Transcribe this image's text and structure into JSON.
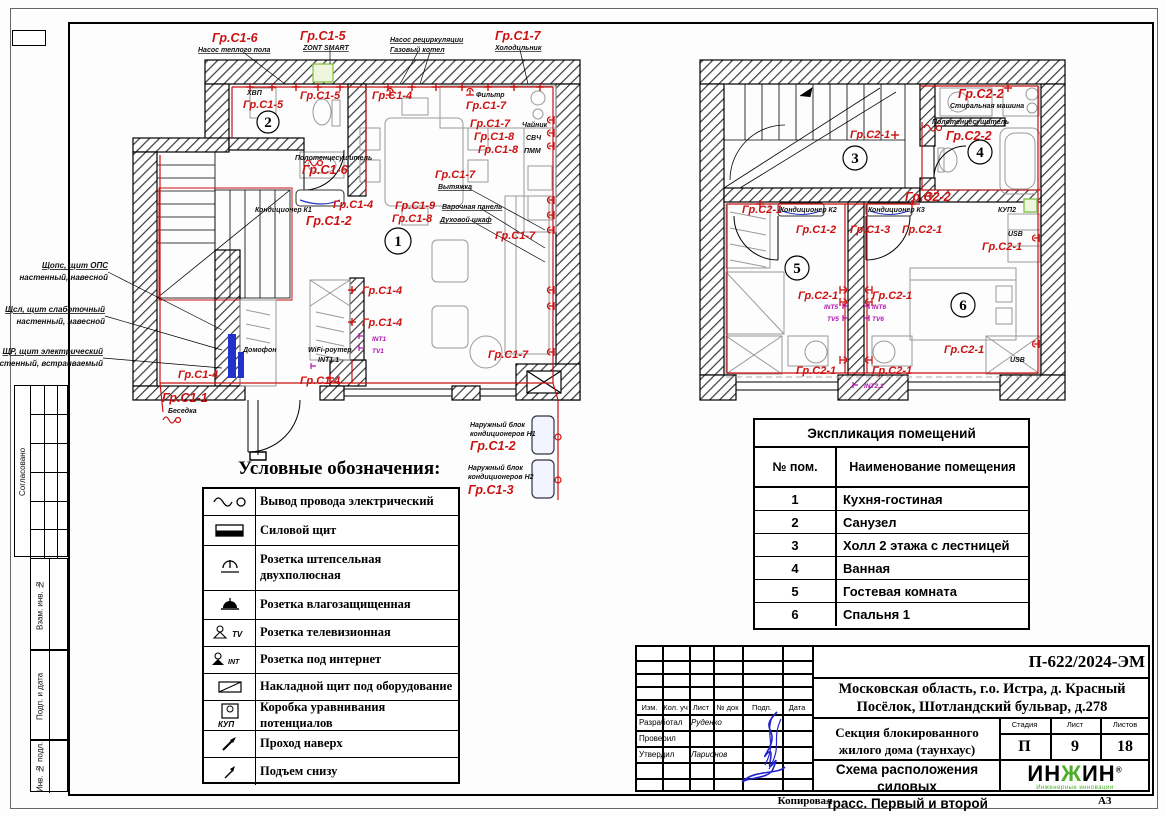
{
  "doc": {
    "copied": "Копировал",
    "format": "А3",
    "side_agreed": "Согласовано",
    "side_vzam": "Взам. инв. №",
    "side_podp": "Подп. и дата",
    "side_inv": "Инв. № подл."
  },
  "groups": {
    "c1_1": "Гр.С1-1",
    "c1_2": "Гр.С1-2",
    "c1_3": "Гр.С1-3",
    "c1_4": "Гр.С1-4",
    "c1_5": "Гр.С1-5",
    "c1_6": "Гр.С1-6",
    "c1_7": "Гр.С1-7",
    "c1_8": "Гр.С1-8",
    "c1_9": "Гр.С1-9",
    "c2_1": "Гр.С2-1",
    "c2_2": "Гр.С2-2"
  },
  "plan1": {
    "rooms": {
      "r1": "1",
      "r2": "2"
    },
    "ann": {
      "pump_floor": "Насос теплого пола",
      "zont": "ZONT SMART",
      "pump_recirc": "Насос рециркуляции",
      "boiler": "Газовый котел",
      "fridge": "Холодильник",
      "hvp": "ХВП",
      "filter": "Фильтр",
      "kettle": "Чайник",
      "svch": "СВЧ",
      "pmm": "ПММ",
      "towel": "Полотенцесушитель",
      "hood": "Вытяжка",
      "hob": "Варочная панель",
      "oven": "Духовой шкаф",
      "ac1": "Кондиционер К1",
      "int1": "INT1",
      "tv1": "TV1",
      "domofon": "Домофон",
      "wifi": "WiFi-роутер",
      "int11": "INT1.1",
      "gazebo": "Беседка",
      "out1a": "Наружный блок",
      "out1b": "кондиционеров Н1",
      "out2a": "Наружный блок",
      "out2b": "кондиционеров Н2",
      "sh1a": "Щопс, щит ОПС",
      "sh1b": "настенный, навесной",
      "sh2a": "Щсл, щит слаботочный",
      "sh2b": "настенный, навесной",
      "sh3a": "ЩР, щит электрический",
      "sh3b": "настенный, встраиваемый"
    }
  },
  "plan2": {
    "rooms": {
      "r3": "3",
      "r4": "4",
      "r5": "5",
      "r6": "6"
    },
    "ann": {
      "washer": "Стиральная машина",
      "towel": "Полотенцесушитель",
      "ac2": "Кондиционер К2",
      "ac3": "Кондиционер К3",
      "kup2": "КУП2",
      "usb": "USB",
      "int5": "INT5",
      "tv5": "TV5",
      "int6": "INT6",
      "tv6": "TV6",
      "int21": "INT2.1"
    }
  },
  "legend": {
    "title": "Условные обозначения:",
    "tag_tv": "TV",
    "tag_int": "INT",
    "tag_kup": "КУП",
    "rows": [
      "Вывод провода электрический",
      "Силовой щит",
      "Розетка штепсельная двухполюсная",
      "Розетка влагозащищенная",
      "Розетка телевизионная",
      "Розетка под интернет",
      "Накладной щит под оборудование",
      "Коробка уравнивания потенциалов",
      "Проход наверх",
      "Подъем снизу"
    ]
  },
  "expl": {
    "title": "Экспликация помещений",
    "col_num": "№ пом.",
    "col_name": "Наименование помещения",
    "rows": [
      {
        "n": "1",
        "name": "Кухня-гостиная"
      },
      {
        "n": "2",
        "name": "Санузел"
      },
      {
        "n": "3",
        "name": "Холл 2 этажа с лестницей"
      },
      {
        "n": "4",
        "name": "Ванная"
      },
      {
        "n": "5",
        "name": "Гостевая комната"
      },
      {
        "n": "6",
        "name": "Спальня 1"
      }
    ]
  },
  "tb": {
    "doc_number": "П-622/2024-ЭМ",
    "addr1": "Московская область, г.о. Истра, д. Красный",
    "addr2": "Посёлок, Шотландский бульвар, д.278",
    "obj1": "Секция блокированного",
    "obj2": "жилого дома (таунхаус)",
    "t1": "Схема расположения силовых",
    "t2": "трасс. Первый и второй этажи",
    "c_izm": "Изм.",
    "c_kol": "Кол. уч",
    "c_list": "Лист",
    "c_ndok": "№ док",
    "c_podp": "Подп.",
    "c_data": "Дата",
    "r_dev": "Разработал",
    "r_dev_name": "Руденко",
    "r_check": "Проверил",
    "r_appr": "Утвердил",
    "r_appr_name": "Ларионов",
    "stage_l": "Стадия",
    "list_l": "Лист",
    "listov_l": "Листов",
    "stage_v": "П",
    "list_v": "9",
    "listov_v": "18",
    "logo_a": "ИН",
    "logo_b": "Ж",
    "logo_c": "ИН",
    "logo_reg": "®",
    "logo_sub": "Инженерные инновации"
  }
}
